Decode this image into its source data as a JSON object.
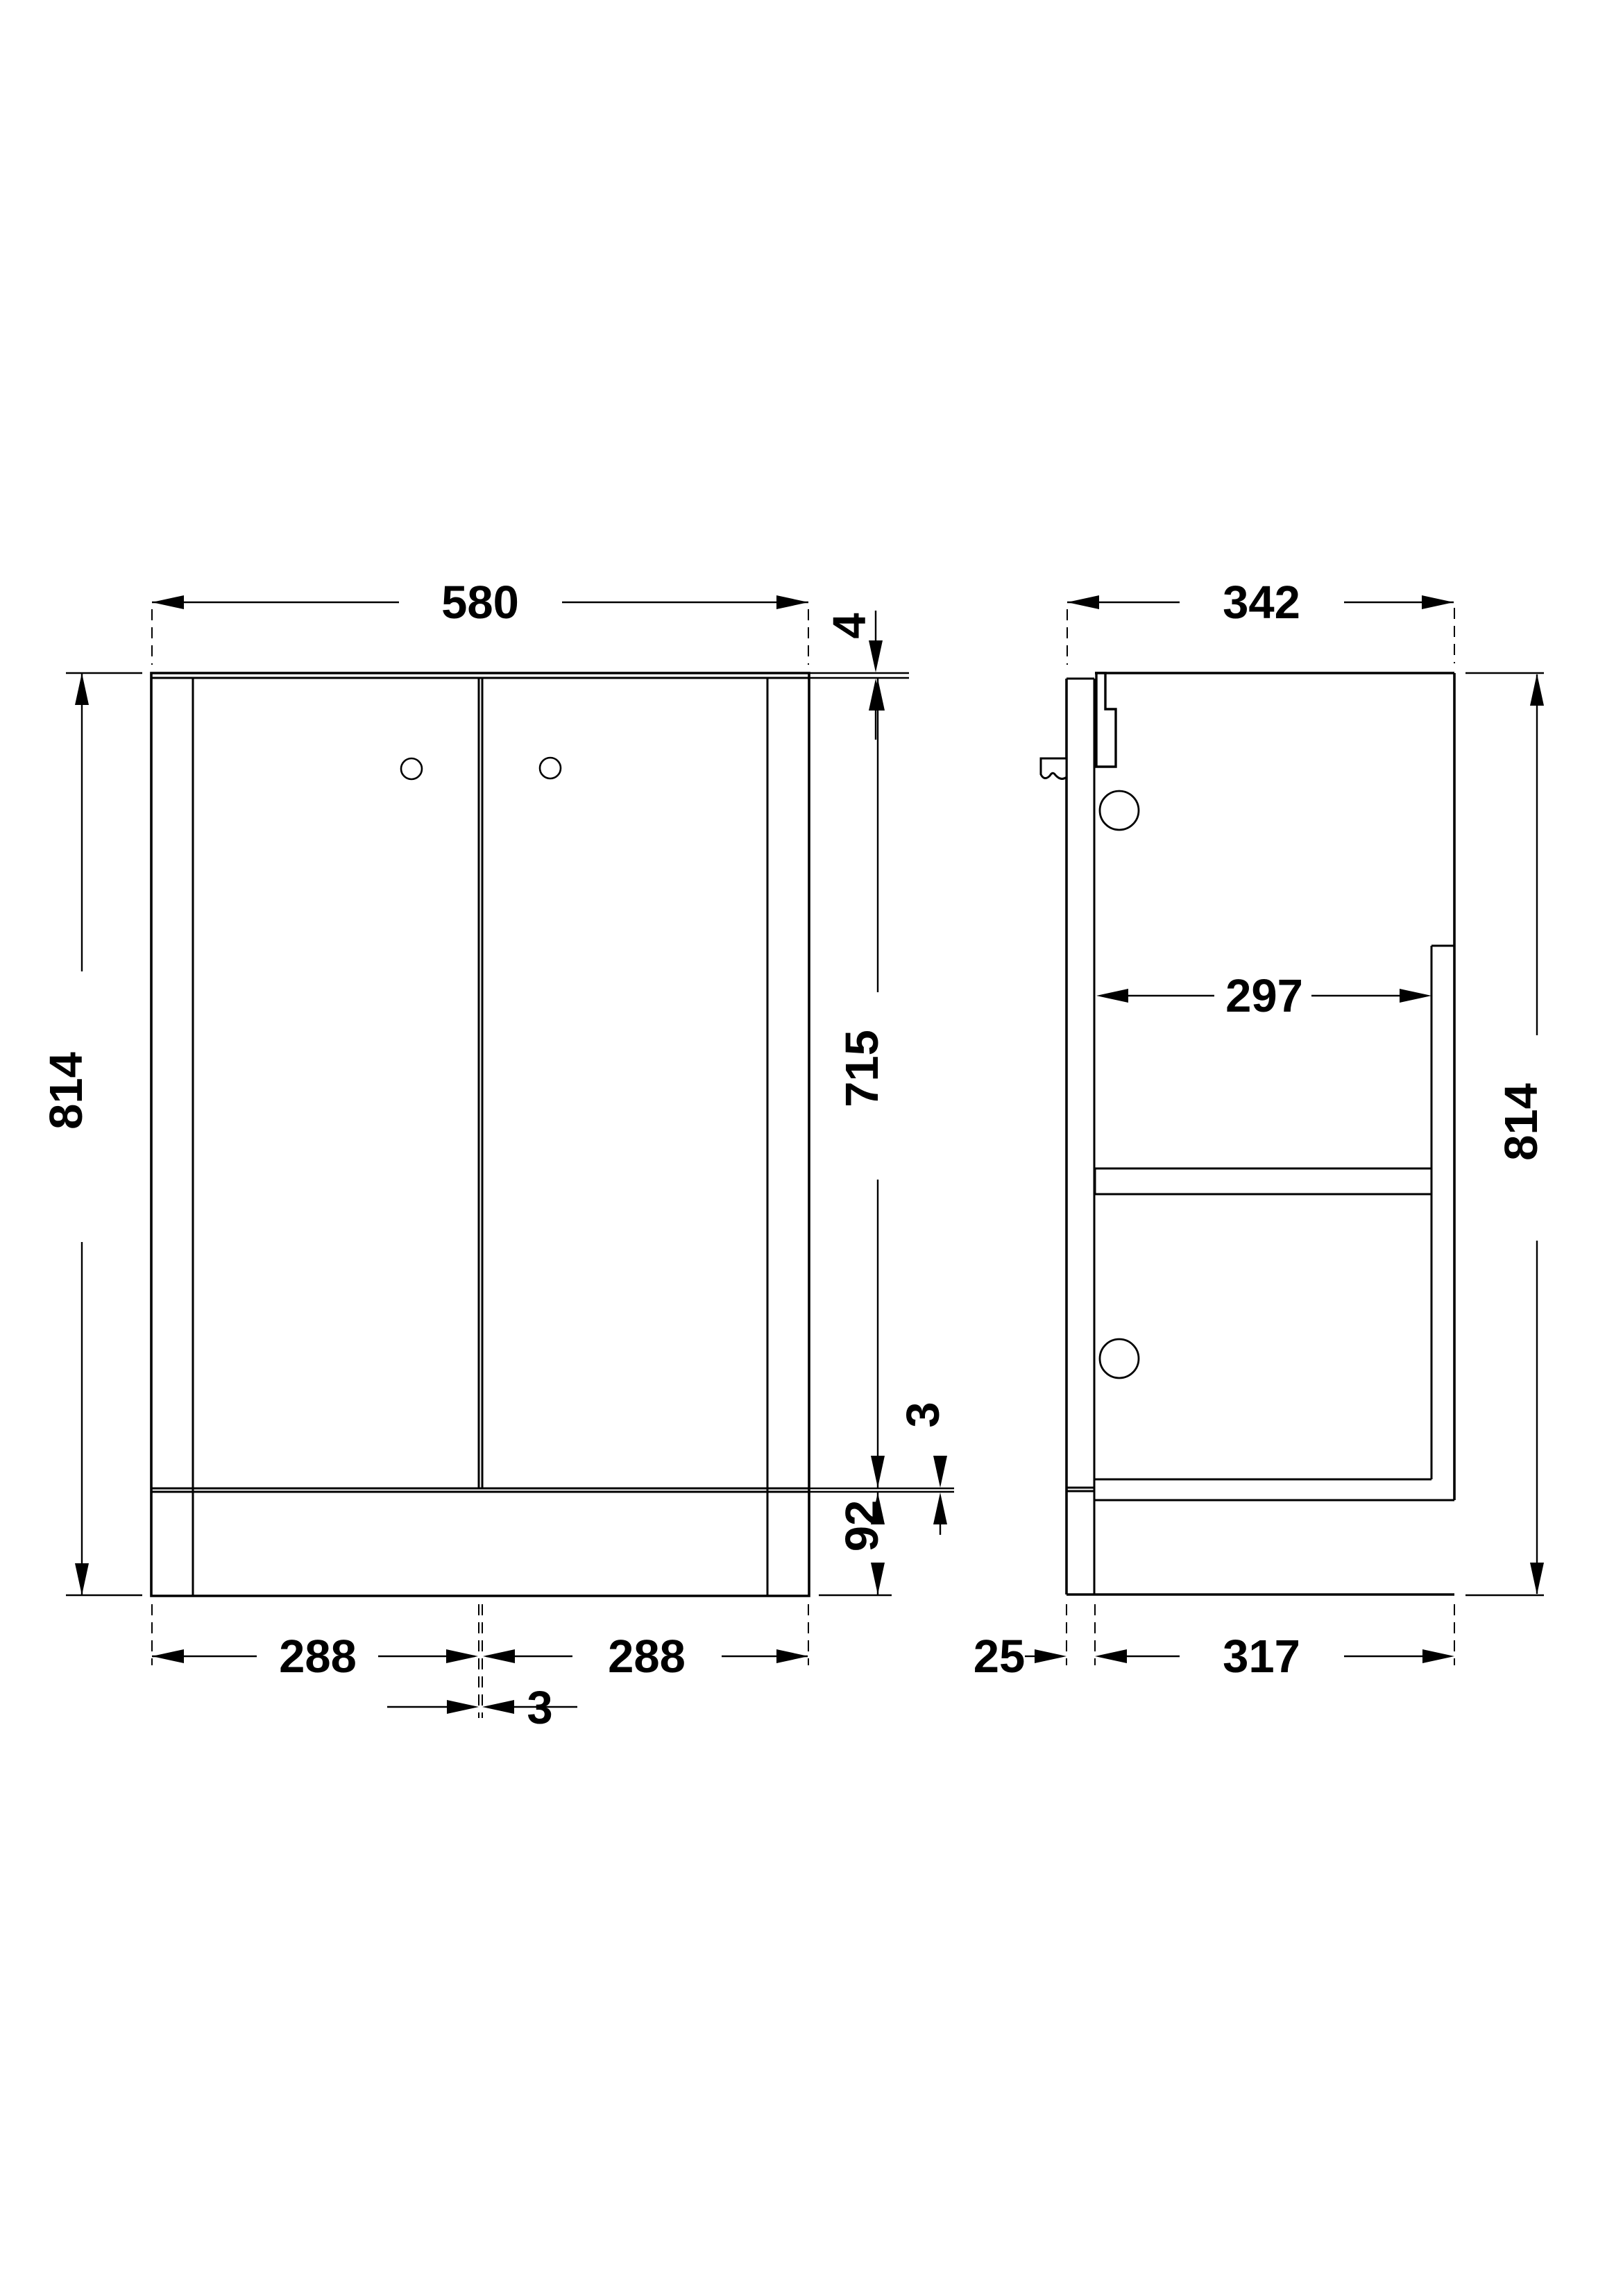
{
  "drawing": {
    "kind": "technical-drawing",
    "subject": "Floor-standing bathroom vanity unit - front and side elevations",
    "units": "mm",
    "line_color": "#000000",
    "background_color": "#ffffff",
    "front_view": {
      "overall_width": "580",
      "top_panel_thickness": "4",
      "overall_height": "814",
      "door_height": "715",
      "door_bottom_gap": "3",
      "plinth_height": "92",
      "left_door_width": "288",
      "right_door_width": "288",
      "centre_door_gap": "3"
    },
    "side_view": {
      "overall_depth": "342",
      "internal_depth": "297",
      "overall_height": "814",
      "door_to_carcass_offset": "25",
      "carcass_depth": "317"
    }
  }
}
